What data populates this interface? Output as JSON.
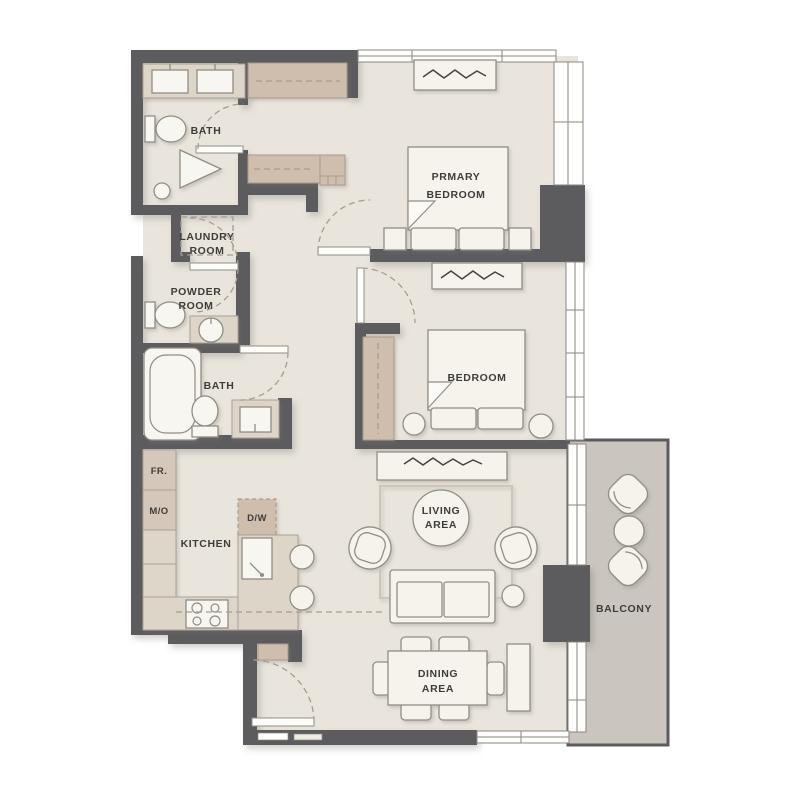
{
  "title": "Two bedroom apartment floor plan",
  "colors": {
    "wall": "#5c5c5e",
    "floor": "#e9e5dd",
    "balcony_floor": "#cac5be",
    "closet_tan": "#cfbdae",
    "counter": "#ddd6c8",
    "furniture": "#f5f3ec",
    "label_text": "#3e3d3b"
  },
  "rooms": {
    "bath_top": {
      "label": "BATH"
    },
    "laundry": {
      "line1": "LAUNDRY",
      "line2": "ROOM"
    },
    "powder": {
      "line1": "POWDER",
      "line2": "ROOM"
    },
    "bath_mid": {
      "label": "BATH"
    },
    "kitchen": {
      "label": "KITCHEN"
    },
    "primary_bedroom": {
      "line1": "PRMARY",
      "line2": "BEDROOM"
    },
    "bedroom": {
      "label": "BEDROOM"
    },
    "living": {
      "line1": "LIVING",
      "line2": "AREA"
    },
    "dining": {
      "line1": "DINING",
      "line2": "AREA"
    },
    "balcony": {
      "label": "BALCONY"
    }
  },
  "appliances": {
    "fridge": "FR.",
    "microwave_oven": "M/O",
    "dishwasher": "D/W"
  }
}
